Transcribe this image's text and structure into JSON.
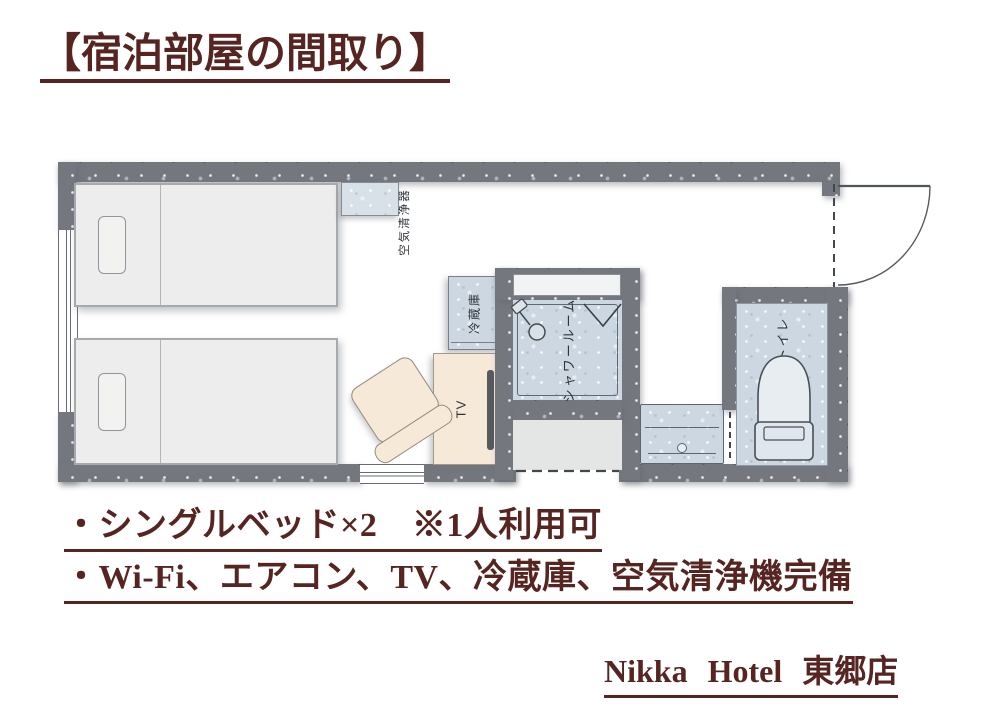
{
  "title": "【宿泊部屋の間取り】",
  "floor_plan": {
    "labels": {
      "air_purifier": "空気清浄器",
      "fridge": "冷蔵庫",
      "shower": "シャワールーム",
      "toilet": "トイレ",
      "tv": "TV"
    }
  },
  "features": [
    "・シングルベッド×2　※1人利用可",
    "・Wi-Fi、エアコン、TV、冷蔵庫、空気清浄機完備"
  ],
  "footer": {
    "hotel_name": "Nikka Hotel 東郷店"
  },
  "colors": {
    "accent_text": "#562521",
    "wall": "#74787e",
    "wet_area": "#ccd7e1",
    "furniture": "#f7e9d8",
    "bed": "#ecedec"
  }
}
